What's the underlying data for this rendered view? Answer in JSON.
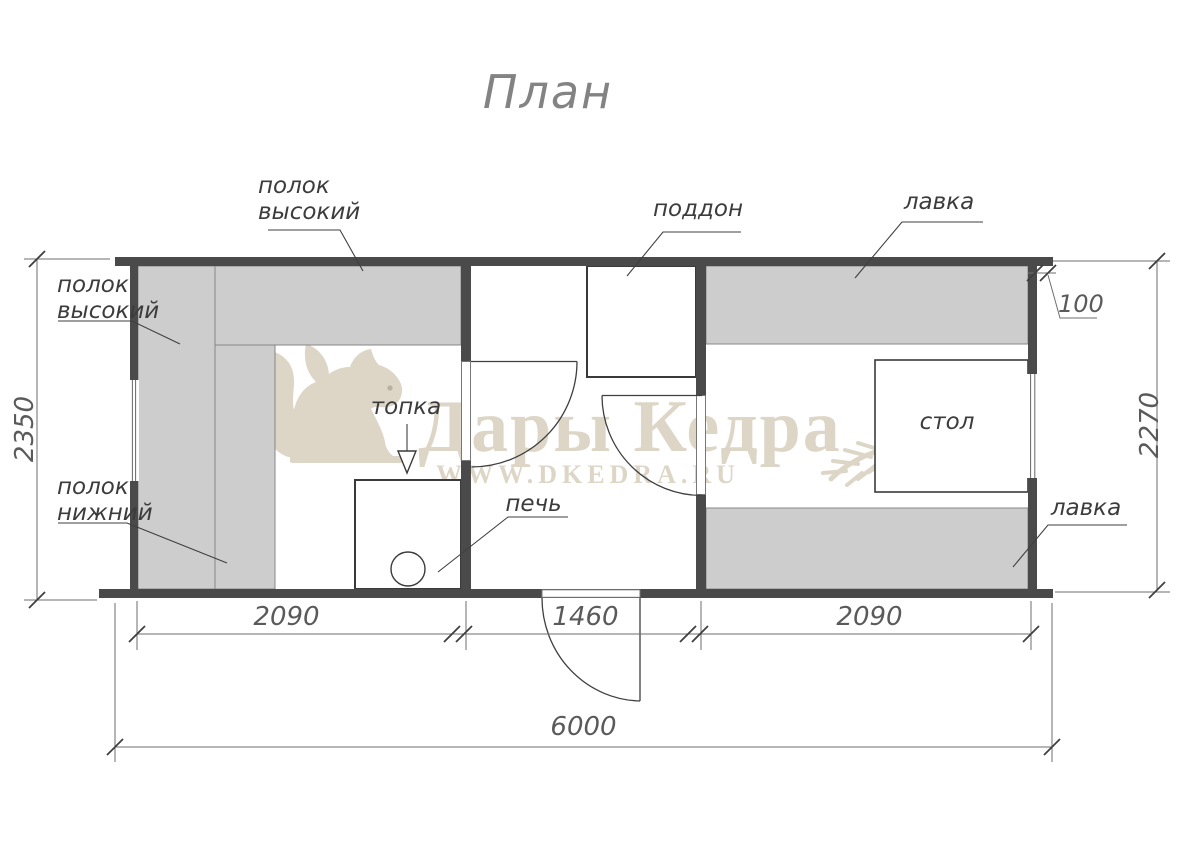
{
  "title": "План",
  "watermark": {
    "brand": "Дары Кедра",
    "url": "WWW.DKEDRA.RU"
  },
  "labels": {
    "shelf_high_top": [
      "полок",
      "высокий"
    ],
    "shelf_high_left": [
      "полок",
      "высокий"
    ],
    "shelf_low": [
      "полок",
      "нижний"
    ],
    "firebox": "топка",
    "stove": "печь",
    "shower_tray": "поддон",
    "bench_top": "лавка",
    "bench_bottom": "лавка",
    "table": "стол"
  },
  "dimensions": {
    "overall_width": "6000",
    "steam_room_width": "2090",
    "washing_room_width": "1460",
    "rest_room_width": "2090",
    "left_side_depth": "2350",
    "right_side_depth": "2270",
    "wall_overhang": "100"
  },
  "colors": {
    "wall": "#4a4a4a",
    "bench_fill": "#cdcdcd",
    "bench_border": "#878787",
    "line": "#3f3f3f",
    "dim_line": "#6e6e6e",
    "watermark": "#ddd6c7"
  }
}
